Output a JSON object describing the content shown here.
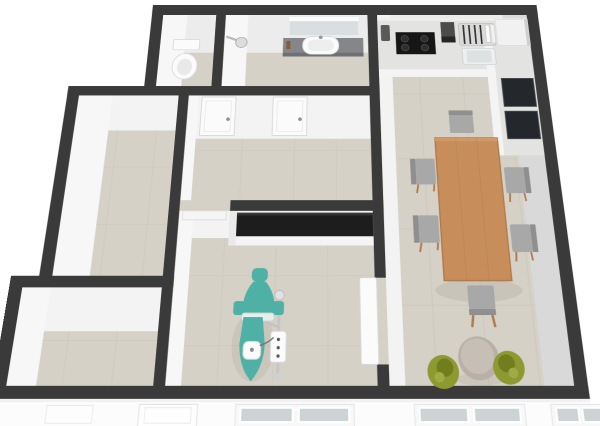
{
  "view": {
    "type": "3d-floor-plan-render",
    "camera": "tilted top-down (dollhouse view)",
    "background": "white, no UI chrome, no text labels"
  },
  "colors": {
    "bg": "#ffffff",
    "wall_top": "#3a3a3a",
    "wall_face": "#f3f3f3",
    "wall_face_bright": "#f7f7f7",
    "wall_face_dim": "#ececec",
    "wall_face_shaded": "#d9d9d9",
    "floor": "#d5d1c6",
    "floor_line": "#c8c3b8",
    "counter": "#e3e3e1",
    "counter_face": "#f4f4f4",
    "counter_dark": "#24282c",
    "black_top": "#1d1d1d",
    "teal": "#4fb0a5",
    "teal_dark": "#3e968c",
    "wood": "#c78e5c",
    "wood_dark": "#b07a4c",
    "seat": "#a8a8a8",
    "seat_dark": "#8f8f8f",
    "olive": "#8d9a31",
    "olive_dark": "#707e1e",
    "glass": "#cdd3d4",
    "metal": "#c6c6c6",
    "white_obj": "#fbfbfb",
    "obj_stroke": "#d8d8d8",
    "vanity": "#84868a",
    "mirror": "#d9dee1",
    "round_table": "#b9b1a8"
  },
  "rooms": {
    "toilet_room": {
      "label": "Toilet room",
      "furniture": [
        "toilet"
      ]
    },
    "bathroom": {
      "label": "Bathroom",
      "furniture": [
        "wall shower head",
        "vanity counter with washbasin",
        "mirror with light"
      ]
    },
    "hallway": {
      "label": "Hallway",
      "furniture": [
        "interior door",
        "interior door"
      ]
    },
    "side_room": {
      "label": "Empty side room",
      "furniture": []
    },
    "entry_room": {
      "label": "Entry room",
      "furniture": []
    },
    "treatment_room": {
      "label": "Treatment room",
      "furniture": [
        "counter with black top",
        "teal dental treatment chair",
        "instrument delivery unit with tray",
        "open white door"
      ]
    },
    "kitchen_living": {
      "label": "Kitchen / living-dining room",
      "furniture": [
        "kitchen counter",
        "cooktop with 4 burners",
        "kettle",
        "coffee machine",
        "dish rack with plates",
        "kitchen sink",
        "refrigerator cabinet",
        "two dark counter modules",
        "wooden dining table",
        "six gray dining chairs",
        "two olive lounge chairs",
        "round side table"
      ]
    }
  },
  "counts": {
    "dining_chairs": 6,
    "lounge_chairs": 2,
    "hallway_doors": 2,
    "facade_window_groups": 3
  },
  "facade": {
    "label": "South facade seen from outside",
    "elements": [
      "entry door",
      "small panel",
      "double-pane window",
      "double-pane window",
      "double-pane window (partial)"
    ]
  }
}
